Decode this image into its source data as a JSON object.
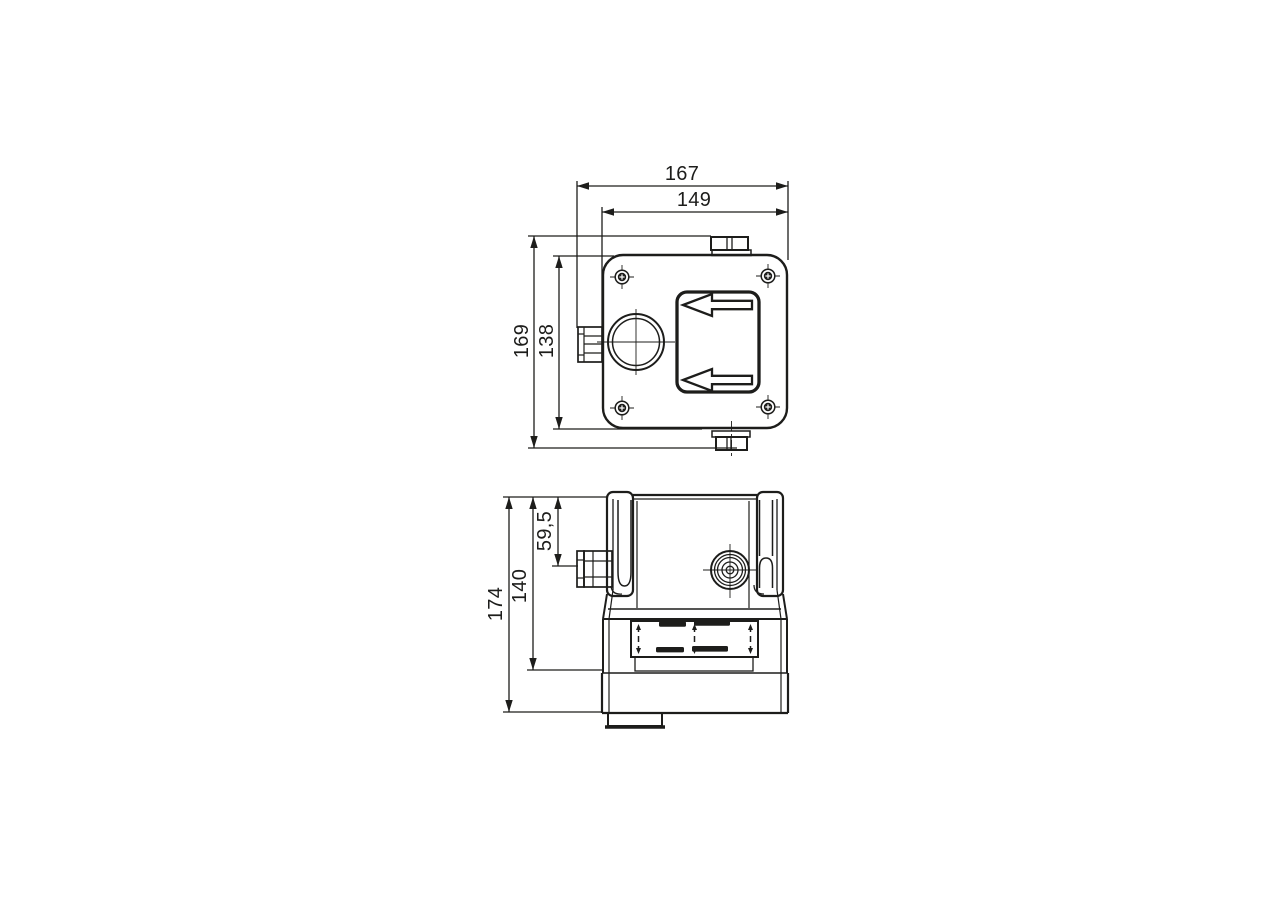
{
  "drawing": {
    "kind": "technical-dimension-drawing",
    "background_color": "#ffffff",
    "line_color": "#1d1d1b",
    "views": {
      "top": {
        "dims": {
          "overall_width": "167",
          "body_width": "149",
          "overall_height": "169",
          "body_height": "138"
        }
      },
      "side": {
        "dims": {
          "overall_height": "174",
          "base_height": "140",
          "gland_offset": "59,5"
        }
      }
    }
  }
}
